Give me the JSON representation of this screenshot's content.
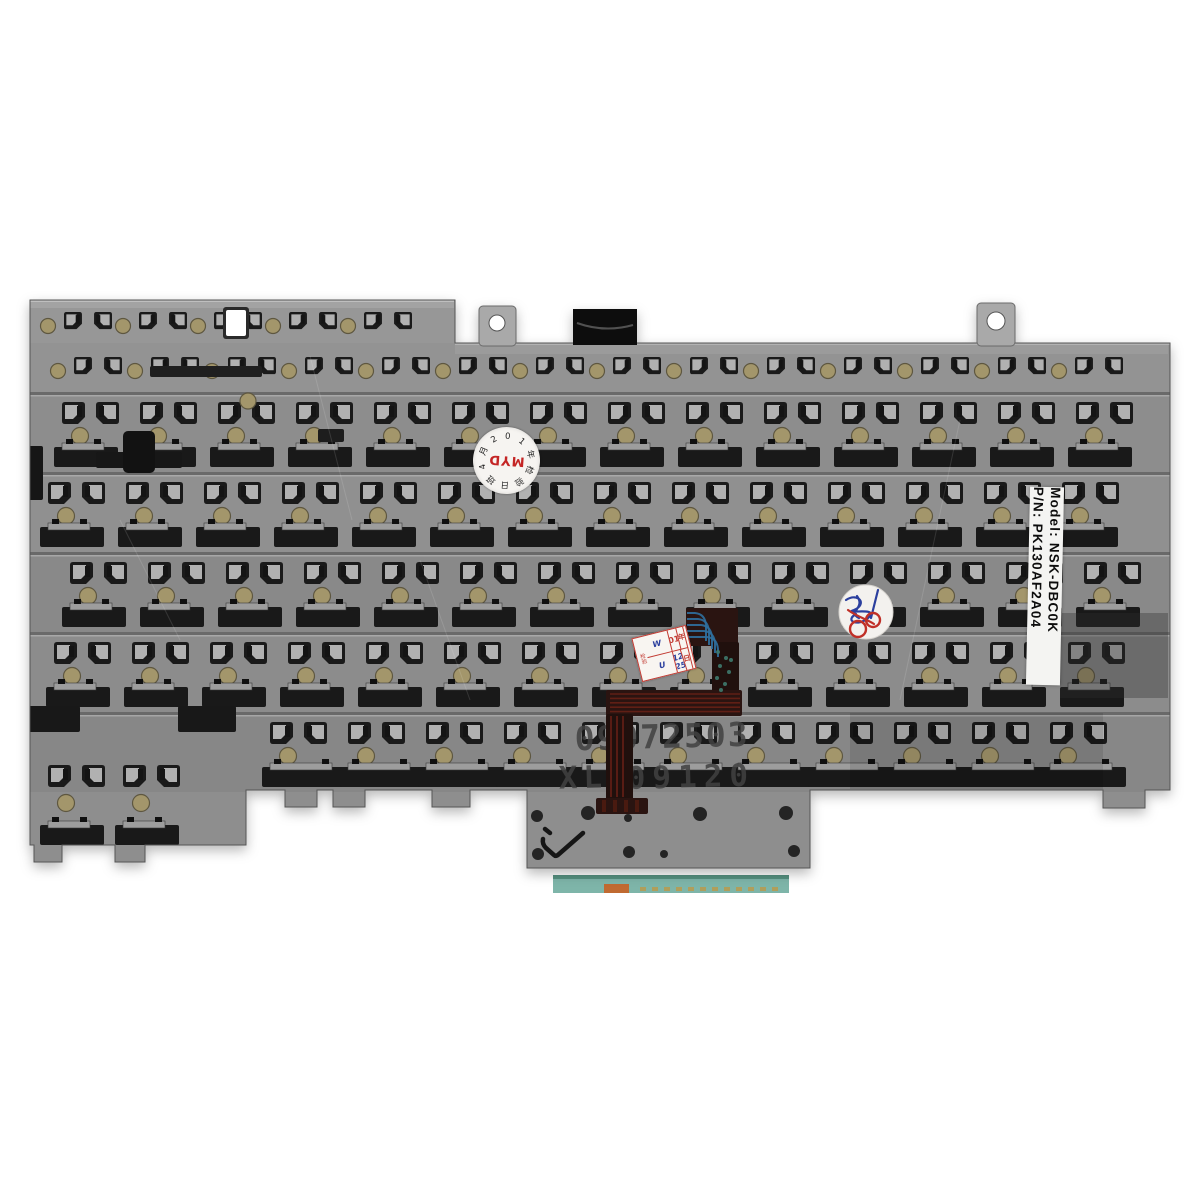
{
  "photo": {
    "description": "Rear metal mounting plate of a laptop keyboard on a white background",
    "background": "#ffffff"
  },
  "part_label": {
    "pn_line": "P/N: PK130AF2A04",
    "model_line": "Model: NSK-DBC0K"
  },
  "stamps": {
    "serial": "09072503",
    "batch_prefix": "XL",
    "batch_digits": "09120",
    "color": "#414141"
  },
  "check_mark": "✓",
  "myd_sticker": {
    "center": "MYD",
    "center_color": "#c42525",
    "ring": [
      "日",
      "班",
      "4",
      "月",
      "2",
      "0",
      "1",
      "年",
      "检",
      "验"
    ]
  },
  "date_sticker": {
    "left_top": "W",
    "left_bottom": "U",
    "year_printed": "201",
    "year_hand": "5",
    "year_unit": "年",
    "day_hand": "12 25",
    "day_unit": "日",
    "side": "检验"
  },
  "plate": {
    "outline": "M30,300 L455,300 L455,343 L1170,343 L1170,790 L1145,790 L1145,808 L1103,808 L1103,790 L810,790 L810,868 L527,868 L527,790 L470,790 L470,807 L432,807 L432,790 L365,790 L365,807 L333,807 L333,790 L317,790 L317,807 L285,807 L285,790 L246,790 L246,845 L145,845 L145,862 L115,862 L115,845 L62,845 L62,862 L34,862 L34,845 L30,845 Z",
    "base_color": "#8f8f8f",
    "cut_color": "#1a1a1a",
    "hook_face": "#b1b1b1",
    "lip_color": "#9d9d9d",
    "dot_color": "#a3966b",
    "dot_edge": "#5e5740",
    "shade_bands": [
      {
        "y": 300,
        "h": 43,
        "f": "#979797"
      },
      {
        "y": 343,
        "h": 49,
        "f": "#939393"
      },
      {
        "y": 392,
        "h": 80,
        "f": "#8d8d8d"
      },
      {
        "y": 472,
        "h": 80,
        "f": "#909090"
      },
      {
        "y": 552,
        "h": 80,
        "f": "#898989"
      },
      {
        "y": 632,
        "h": 80,
        "f": "#8c8c8c"
      },
      {
        "y": 712,
        "h": 80,
        "f": "#878787"
      },
      {
        "y": 792,
        "h": 80,
        "f": "#8e8e8e"
      }
    ],
    "seams": [
      392,
      472,
      552,
      632,
      712
    ],
    "bands": [
      {
        "kind": "mini",
        "y": 306,
        "x0": 64,
        "x1": 440,
        "pitch": 75,
        "offset": 0
      },
      {
        "kind": "mini",
        "y": 351,
        "x0": 64,
        "x1": 1150,
        "pitch": 77,
        "offset": 10
      },
      {
        "kind": "main",
        "y": 392,
        "x0": 42,
        "x1": 1155,
        "pitch": 78,
        "offset": 14
      },
      {
        "kind": "main",
        "y": 472,
        "x0": 42,
        "x1": 1155,
        "pitch": 78,
        "offset": 0
      },
      {
        "kind": "main",
        "y": 552,
        "x0": 42,
        "x1": 1155,
        "pitch": 78,
        "offset": 22
      },
      {
        "kind": "main",
        "y": 632,
        "x0": 42,
        "x1": 1155,
        "pitch": 78,
        "offset": 6
      },
      {
        "kind": "main",
        "y": 712,
        "x0": 250,
        "x1": 1155,
        "pitch": 78,
        "offset": 14,
        "slotW": 84
      },
      {
        "kind": "main",
        "y": 745,
        "x0": 42,
        "x1": 246,
        "pitch": 75,
        "offset": 0,
        "rel": {
          "hook": 20,
          "dot": 58,
          "slot": 80
        }
      }
    ],
    "patches": [
      {
        "x": 150,
        "y": 366,
        "w": 112,
        "h": 11,
        "f": "#1f1f1f",
        "r": 2
      },
      {
        "x": 96,
        "y": 452,
        "w": 86,
        "h": 16,
        "f": "#171717",
        "r": 2
      },
      {
        "x": 123,
        "y": 431,
        "w": 32,
        "h": 42,
        "f": "#121212",
        "r": 5
      },
      {
        "x": 28,
        "y": 446,
        "w": 15,
        "h": 54,
        "f": "#161616",
        "r": 2
      },
      {
        "x": 318,
        "y": 429,
        "w": 26,
        "h": 13,
        "f": "#1d1d1d",
        "r": 2
      },
      {
        "x": 28,
        "y": 706,
        "w": 52,
        "h": 26,
        "f": "#181818",
        "r": 2
      },
      {
        "x": 178,
        "y": 706,
        "w": 58,
        "h": 26,
        "f": "#181818",
        "r": 2
      },
      {
        "x": 1060,
        "y": 613,
        "w": 108,
        "h": 85,
        "f": "#2e2e2e",
        "o": 0.35,
        "r": 0
      },
      {
        "x": 455,
        "y": 344,
        "w": 713,
        "h": 10,
        "f": "#ffffff",
        "o": 0.08,
        "r": 0
      },
      {
        "x": 30,
        "y": 300,
        "w": 424,
        "h": 8,
        "f": "#ffffff",
        "o": 0.12,
        "r": 0
      },
      {
        "x": 850,
        "y": 713,
        "w": 253,
        "h": 76,
        "f": "#000000",
        "o": 0.1,
        "r": 0
      }
    ],
    "holes": [
      [
        537,
        816,
        6
      ],
      [
        588,
        813,
        7
      ],
      [
        700,
        814,
        7
      ],
      [
        786,
        813,
        7
      ],
      [
        628,
        818,
        4
      ],
      [
        538,
        854,
        6
      ],
      [
        629,
        852,
        6
      ],
      [
        664,
        854,
        4
      ],
      [
        794,
        851,
        6
      ],
      [
        296,
        815,
        4
      ]
    ],
    "bosses": [
      [
        248,
        401,
        8
      ]
    ],
    "scratches": [
      {
        "x1": 310,
        "y1": 356,
        "x2": 352,
        "y2": 520
      },
      {
        "x1": 960,
        "y1": 420,
        "x2": 900,
        "y2": 700
      },
      {
        "x1": 420,
        "y1": 560,
        "x2": 470,
        "y2": 700
      },
      {
        "x1": 120,
        "y1": 520,
        "x2": 180,
        "y2": 640
      }
    ],
    "tabs": {
      "tabA": {
        "x": 479,
        "y": 306,
        "w": 37,
        "h": 40,
        "hole": [
          497,
          323,
          8
        ]
      },
      "tabB": {
        "x": 573,
        "y": 309,
        "w": 64,
        "h": 36
      },
      "tabC": {
        "x": 977,
        "y": 303,
        "w": 38,
        "h": 43,
        "hole": [
          996,
          321,
          9
        ]
      }
    },
    "white_cutout": {
      "x": 226,
      "y": 310,
      "w": 20,
      "h": 26
    }
  },
  "cable": {
    "base": "#2a1411",
    "dark": "#20100d",
    "rects": [
      [
        686,
        608,
        52,
        38
      ],
      [
        712,
        642,
        27,
        54
      ],
      [
        606,
        690,
        136,
        26
      ],
      [
        606,
        714,
        27,
        86
      ],
      [
        596,
        798,
        52,
        16
      ]
    ],
    "blue": "#2f6f9f",
    "red": "#6e2217",
    "via": "#3e7a6d"
  },
  "connector": {
    "x": 553,
    "y": 875,
    "w": 236,
    "h": 18,
    "teal": "#7eb5a9",
    "edge": "#55907f",
    "orange": {
      "x": 604,
      "y": 884,
      "w": 25,
      "h": 9,
      "c": "#c06a31"
    },
    "contact": "#b99a4e"
  }
}
